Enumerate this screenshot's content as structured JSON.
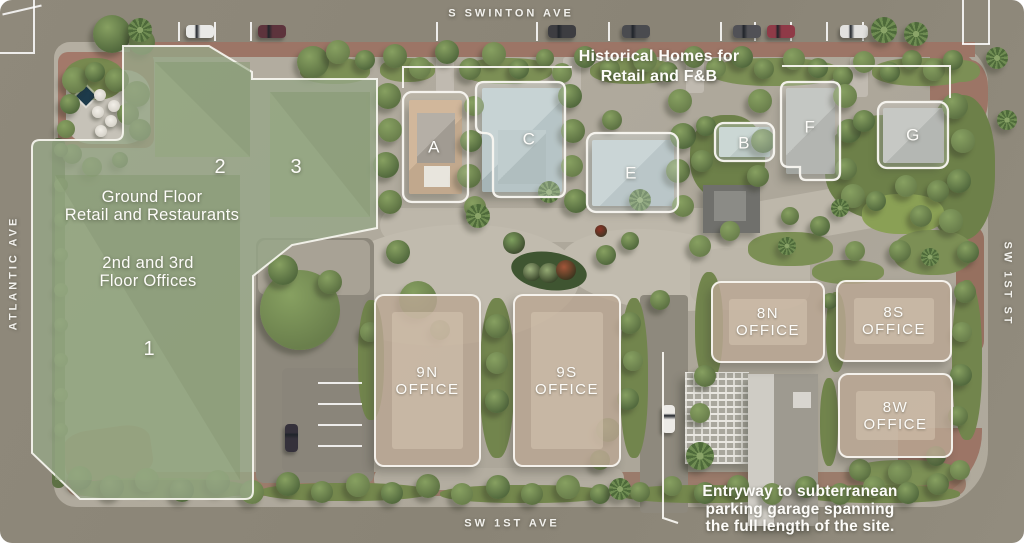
{
  "colors": {
    "street": "#8c8678",
    "pavement": "#b2ac9f",
    "sidewalk_brick": "#9c7566",
    "lawn": "#7c8f55",
    "green_overlay": "#96a687",
    "office_overlay": "#b7a492",
    "outline_white": "#f7f5ef",
    "label_text": "#fdfcf9",
    "fountain": "#1d3a4a",
    "accent_plant": "#a2563a"
  },
  "streets": {
    "top": "S SWINTON AVE",
    "left": "ATLANTIC AVE",
    "right": "SW 1ST ST",
    "bottom": "SW 1ST AVE"
  },
  "green_complex": {
    "numbers": {
      "b1": "1",
      "b2": "2",
      "b3": "3"
    },
    "note_ground": {
      "line1": "Ground Floor",
      "line2": "Retail and Restaurants"
    },
    "note_upper": {
      "line1": "2nd and 3rd",
      "line2": "Floor Offices"
    }
  },
  "historic_homes": {
    "note": {
      "line1": "Historical Homes for",
      "line2": "Retail and F&B"
    },
    "labels": {
      "a": "A",
      "b": "B",
      "c": "C",
      "e": "E",
      "f": "F",
      "g": "G"
    }
  },
  "offices": {
    "o9n": {
      "line1": "9N",
      "line2": "OFFICE"
    },
    "o9s": {
      "line1": "9S",
      "line2": "OFFICE"
    },
    "o8n": {
      "line1": "8N",
      "line2": "OFFICE"
    },
    "o8s": {
      "line1": "8S",
      "line2": "OFFICE"
    },
    "o8w": {
      "line1": "8W",
      "line2": "OFFICE"
    }
  },
  "garage_note": {
    "line1": "Entryway to subterranean",
    "line2": "parking garage spanning",
    "line3": "the full length of the site."
  }
}
